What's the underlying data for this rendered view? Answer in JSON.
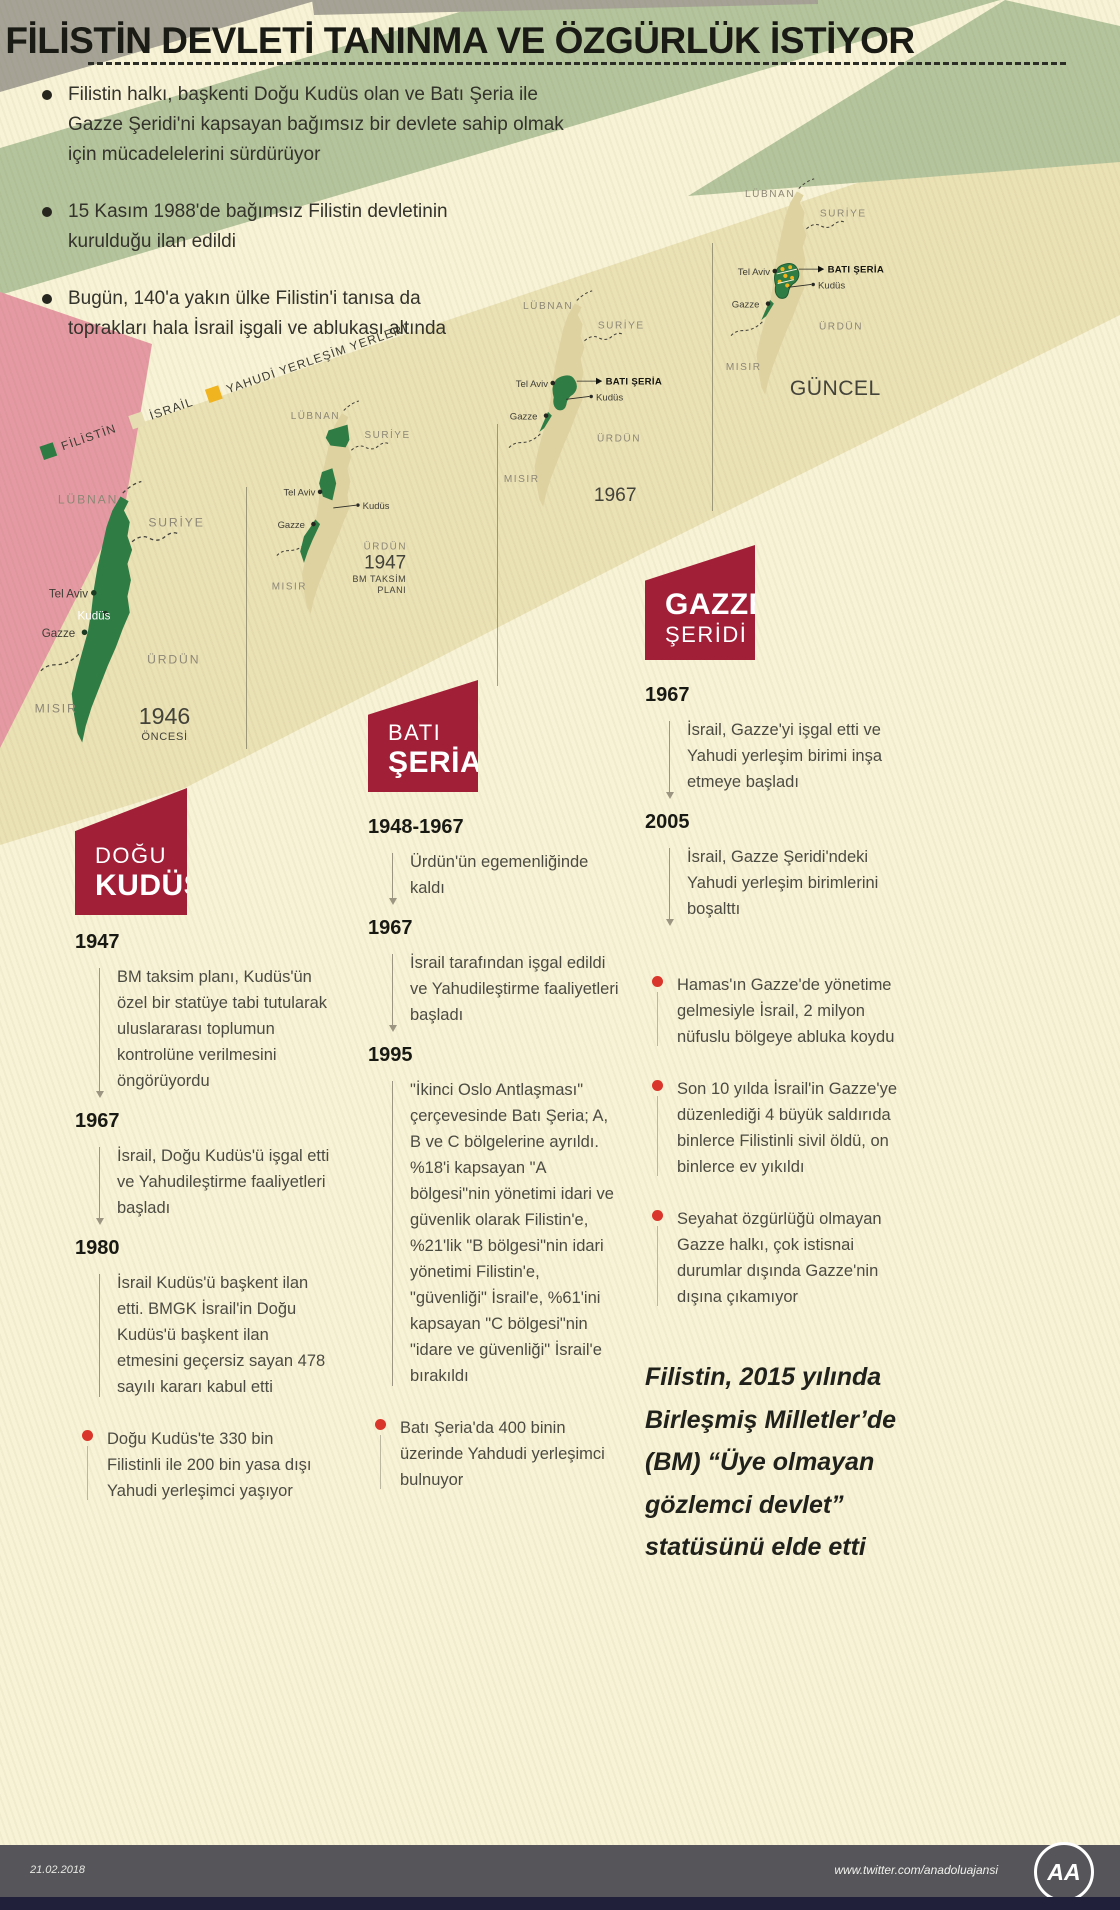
{
  "title": "FİLİSTİN DEVLETİ TANINMA VE ÖZGÜRLÜK İSTİYOR",
  "intro": {
    "bullets": [
      "Filistin halkı, başkenti Doğu Kudüs olan ve Batı Şeria ile Gazze Şeridi'ni kapsayan bağımsız bir devlete sahip olmak için mücadelelerini sürdürüyor",
      "15 Kasım 1988'de bağımsız Filistin devletinin kurulduğu ilan edildi",
      "Bugün, 140'a yakın ülke Filistin'i tanısa da toprakları hala İsrail işgali ve ablukası altında"
    ]
  },
  "legend": {
    "items": [
      {
        "label": "FİLİSTİN",
        "color": "#2e7b43"
      },
      {
        "label": "İSRAİL",
        "color": "#e6ddb2"
      },
      {
        "label": "YAHUDİ YERLEŞİM YERLERİ",
        "color": "#efb41f"
      }
    ]
  },
  "maps": {
    "labels": {
      "lubnan": "LÜBNAN",
      "suriye": "SURİYE",
      "urdun": "ÜRDÜN",
      "misir": "MISIR",
      "tel_aviv": "Tel Aviv",
      "kudus": "Kudüs",
      "gazze": "Gazze",
      "bati_seria": "BATI ŞERİA"
    },
    "m1946": {
      "caption_year": "1946",
      "caption_sub": "ÖNCESİ"
    },
    "m1947": {
      "caption_year": "1947",
      "caption_sub1": "BM TAKSİM",
      "caption_sub2": "PLANI"
    },
    "m1967": {
      "caption_year": "1967"
    },
    "guncel": {
      "caption": "GÜNCEL"
    }
  },
  "columns": {
    "dogu_kudus": {
      "header_line1": "DOĞU",
      "header_line2": "KUDÜS",
      "entries": [
        {
          "year": "1947",
          "text": "BM taksim planı, Kudüs'ün özel bir statüye tabi tutularak uluslararası toplumun kontrolüne verilmesini öngörüyordu"
        },
        {
          "year": "1967",
          "text": "İsrail, Doğu Kudüs'ü işgal etti ve Yahudileştirme faaliyetleri başladı"
        },
        {
          "year": "1980",
          "text": "İsrail Kudüs'ü başkent ilan etti. BMGK İsrail'in Doğu Kudüs'ü başkent ilan etmesini geçersiz sayan 478 sayılı kararı kabul etti"
        }
      ],
      "bullet": "Doğu Kudüs'te 330 bin Filistinli ile 200 bin yasa dışı Yahudi yerleşimci yaşıyor"
    },
    "bati_seria": {
      "header_line1": "BATI",
      "header_line2": "ŞERİA",
      "entries": [
        {
          "year": "1948-1967",
          "text": "Ürdün'ün egemenliğinde kaldı"
        },
        {
          "year": "1967",
          "text": "İsrail tarafından işgal edildi ve Yahudileştirme faaliyetleri başladı"
        },
        {
          "year": "1995",
          "text": "\"İkinci Oslo Antlaşması\" çerçevesinde Batı Şeria; A, B ve C bölgelerine ayrıldı. %18'i kapsayan \"A bölgesi\"nin yönetimi idari ve güvenlik olarak Filistin'e, %21'lik \"B bölgesi\"nin idari yönetimi Filistin'e, \"güvenliği\" İsrail'e, %61'ini kapsayan \"C bölgesi\"nin \"idare ve güvenliği\" İsrail'e bırakıldı"
        }
      ],
      "bullet": "Batı Şeria'da 400 binin üzerinde Yahdudi yerleşimci bulnuyor"
    },
    "gazze": {
      "header_line1": "GAZZE",
      "header_line2": "ŞERİDİ",
      "entries": [
        {
          "year": "1967",
          "text": "İsrail, Gazze'yi işgal etti ve Yahudi yerleşim birimi inşa etmeye başladı"
        },
        {
          "year": "2005",
          "text": "İsrail, Gazze Şeridi'ndeki Yahudi yerleşim birimlerini boşalttı"
        }
      ],
      "bullets": [
        "Hamas'ın Gazze'de yönetime gelmesiyle İsrail, 2 milyon nüfuslu bölgeye abluka koydu",
        "Son 10 yılda İsrail'in Gazze'ye düzenlediği 4 büyük saldırıda binlerce Filistinli sivil öldü, on binlerce ev yıkıldı",
        "Seyahat özgürlüğü olmayan Gazze halkı, çok istisnai durumlar dışında Gazze'nin dışına çıkamıyor"
      ]
    }
  },
  "note": "Filistin, 2015 yılında Birleşmiş Milletler’de (BM) “Üye olmayan gözlemci devlet” statüsünü elde etti",
  "footer": {
    "date": "21.02.2018",
    "handle": "www.twitter.com/anadoluajansi",
    "logo": "AA"
  }
}
